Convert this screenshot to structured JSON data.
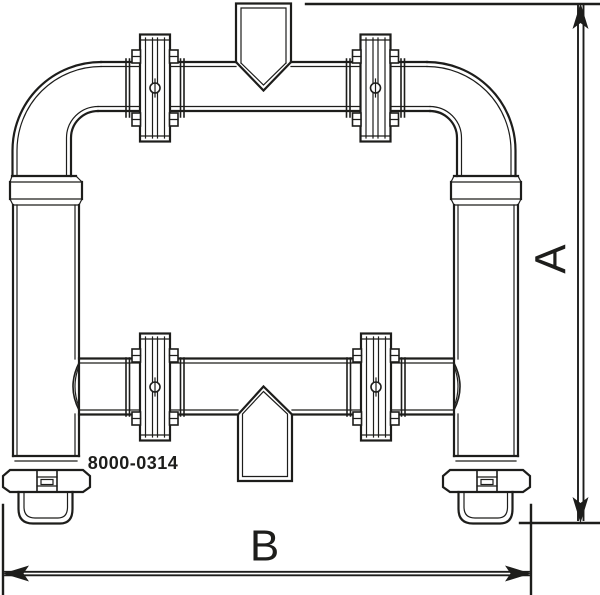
{
  "page": {
    "background": "#ffffff"
  },
  "drawing": {
    "line_color": "#1d1d1b",
    "part_number": "8000-0314",
    "dimension_a_label": "A",
    "dimension_b_label": "B"
  }
}
